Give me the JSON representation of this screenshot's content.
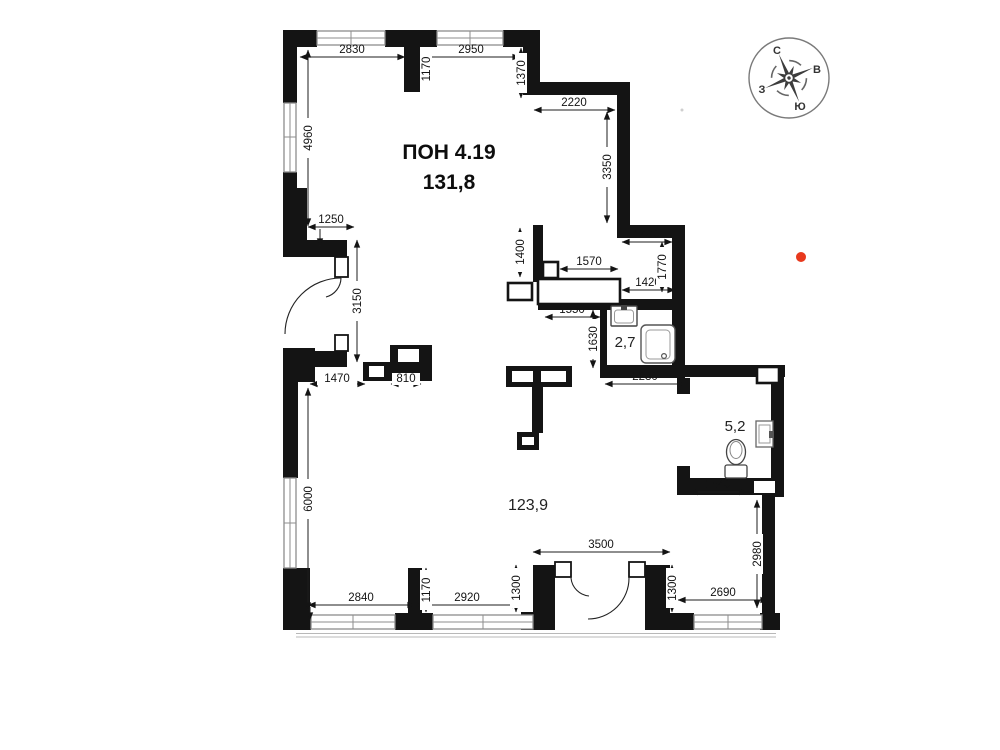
{
  "plan": {
    "title_line1": "ПОН 4.19",
    "title_line2": "131,8",
    "areas": {
      "main": "123,9",
      "bathroom": "2,7",
      "wc": "5,2"
    }
  },
  "compass": {
    "north": "С",
    "east": "В",
    "west": "З",
    "south": "Ю"
  },
  "annotations": {
    "red_dot_color": "#e8391d"
  },
  "dimensions": {
    "top_2830": "2830",
    "top_1170": "1170",
    "top_2950": "2950",
    "top_1370": "1370",
    "right_2220": "2220",
    "right_3350": "3350",
    "left_4960": "4960",
    "left_1250": "1250",
    "mid_1400v": "1400",
    "mid_1570": "1570",
    "mid_1400h": "1400",
    "mid_1770": "1770",
    "mid_1420": "1420",
    "mid_1550": "1550",
    "bath_1630": "1630",
    "entry_3150": "3150",
    "bath_2230": "2230",
    "hall_1470": "1470",
    "hall_810": "810",
    "wc_1540": "1540",
    "right_2980": "2980",
    "left_6000": "6000",
    "bottom_3500": "3500",
    "bottom_2840": "2840",
    "bottom_1170": "1170",
    "bottom_2920": "2920",
    "bottom_1300l": "1300",
    "bottom_1300r": "1300",
    "bottom_2690": "2690"
  }
}
